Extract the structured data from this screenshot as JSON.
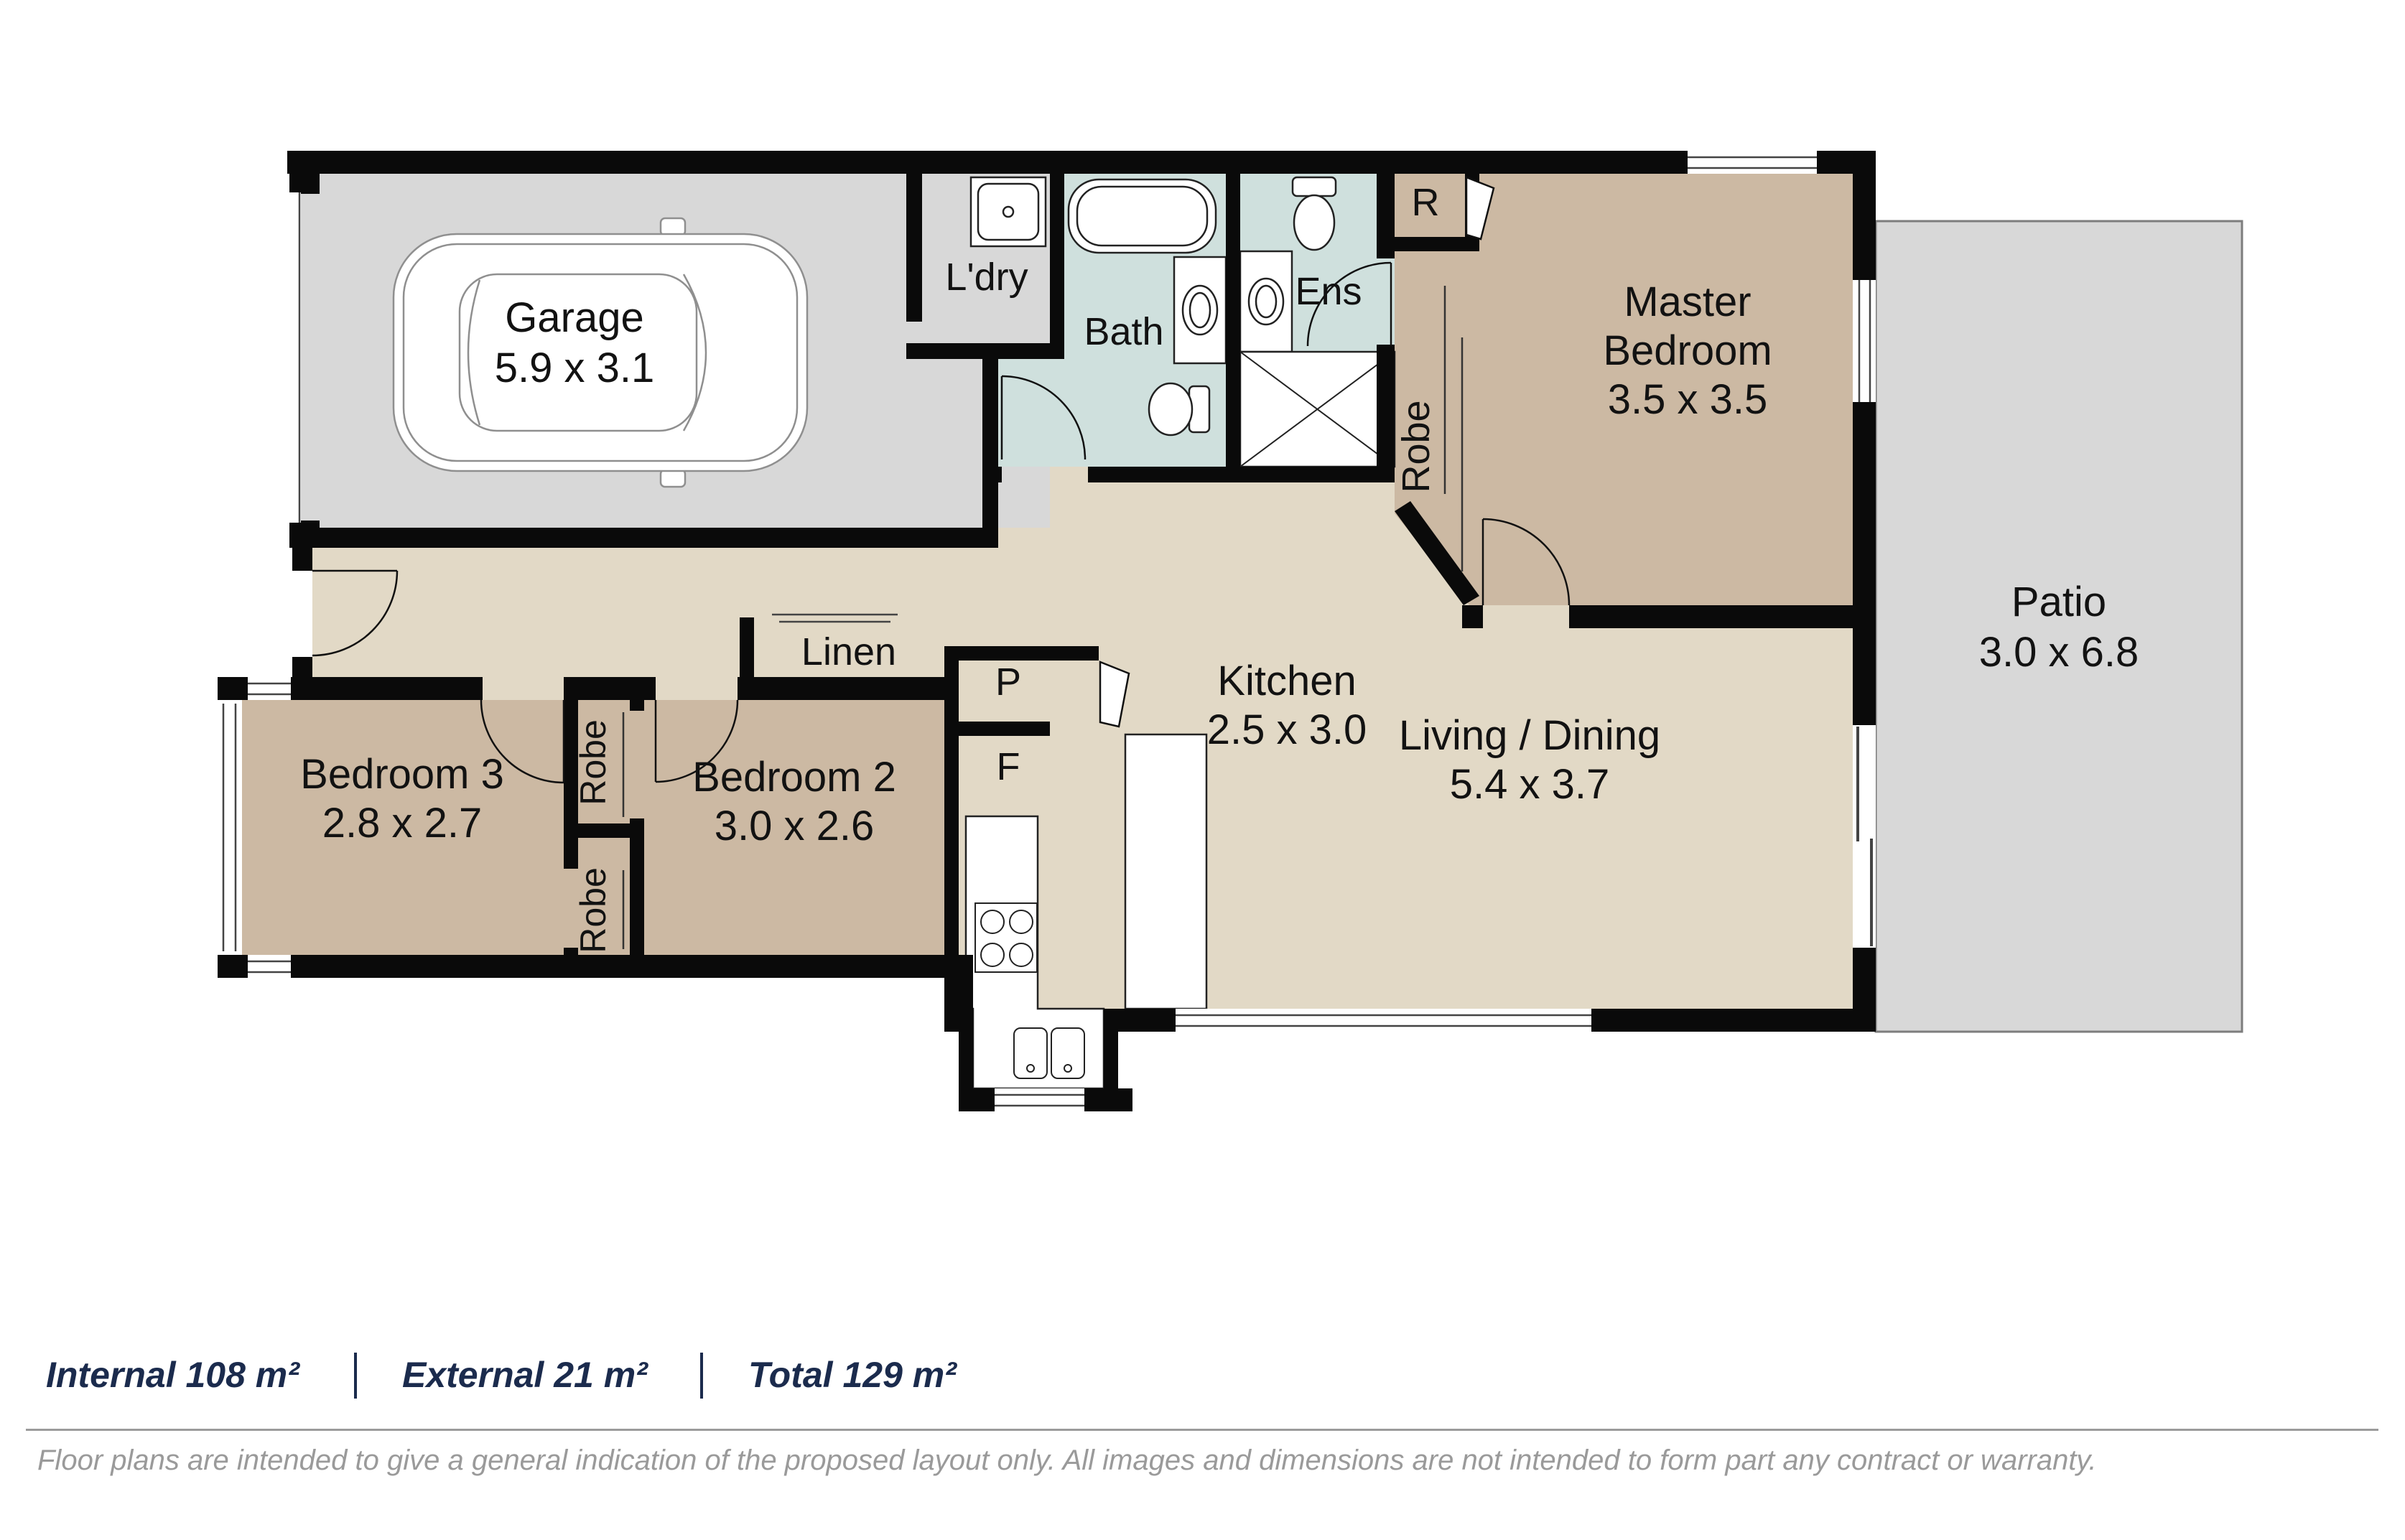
{
  "colors": {
    "wall": "#0a0a0a",
    "floor_main": "#e2d9c6",
    "floor_bedroom": "#ccb9a3",
    "floor_wet": "#cfe0dd",
    "floor_garage": "#d8d8d8",
    "floor_patio": "#d8d8d8",
    "stats_text": "#1b2b4d",
    "muted_text": "#9a9a9a"
  },
  "labels": {
    "garage": "Garage",
    "garage_dims": "5.9 x 3.1",
    "laundry": "L'dry",
    "bath": "Bath",
    "ens": "Ens",
    "robe_r": "R",
    "robe_master": "Robe",
    "master_1": "Master",
    "master_2": "Bedroom",
    "master_dims": "3.5 x 3.5",
    "patio": "Patio",
    "patio_dims": "3.0 x 6.8",
    "kitchen": "Kitchen",
    "kitchen_dims": "2.5 x 3.0",
    "pantry": "P",
    "fridge": "F",
    "linen": "Linen",
    "living": "Living / Dining",
    "living_dims": "5.4 x 3.7",
    "bedroom2": "Bedroom 2",
    "bedroom2_dims": "3.0 x 2.6",
    "bedroom3": "Bedroom 3",
    "bedroom3_dims": "2.8 x 2.7",
    "robe_upper": "Robe",
    "robe_lower": "Robe"
  },
  "footer": {
    "internal": "Internal 108 m²",
    "external": "External 21 m²",
    "total": "Total 129 m²",
    "disclaimer": "Floor plans are intended to give a general indication of the proposed layout only. All images and dimensions are not intended to form part any contract or warranty."
  }
}
